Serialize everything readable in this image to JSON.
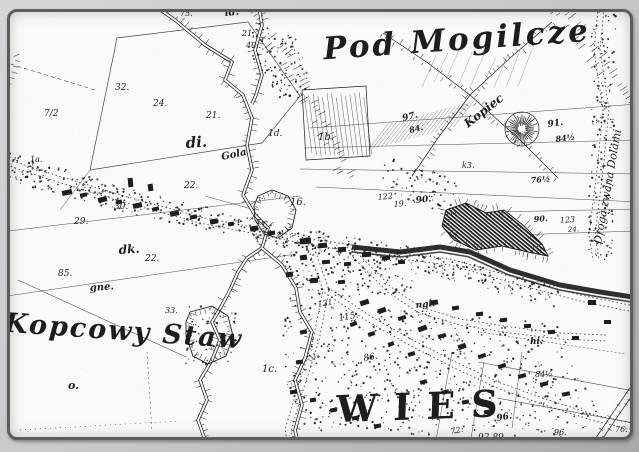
{
  "map": {
    "titles": {
      "region": "Pod Mogilcze",
      "pond": "Kopcowy Staw",
      "village": "WIES",
      "road": "Droga zwana Dolami"
    },
    "colors": {
      "ink": "#1d1d1d",
      "paper": "#fbfaf7",
      "frame": "#5d5d5d",
      "margin": "#c9c9c9"
    },
    "symbols": [
      {
        "name": "mound-hatched-circle",
        "x": 522,
        "y": 129
      },
      {
        "name": "river-double-bank",
        "note": "meandering stream with bank hatching"
      },
      {
        "name": "village-buildings",
        "note": "black rectangles along streets"
      }
    ],
    "labels": [
      {
        "t": "id.",
        "x": 225,
        "y": 16,
        "s": 10,
        "r": -5,
        "c": "s"
      },
      {
        "t": "75.",
        "x": 180,
        "y": 16,
        "s": 8,
        "r": 0,
        "c": "n"
      },
      {
        "t": "21.",
        "x": 242,
        "y": 36,
        "s": 8,
        "r": 0,
        "c": "n"
      },
      {
        "t": "40.",
        "x": 246,
        "y": 48,
        "s": 8,
        "r": 0,
        "c": "n"
      },
      {
        "t": "32.",
        "x": 115,
        "y": 90,
        "s": 9,
        "r": 0,
        "c": "n"
      },
      {
        "t": "7/2",
        "x": 44,
        "y": 116,
        "s": 9,
        "r": 0,
        "c": "n"
      },
      {
        "t": "24.",
        "x": 153,
        "y": 106,
        "s": 9,
        "r": 0,
        "c": "n"
      },
      {
        "t": "21.",
        "x": 206,
        "y": 118,
        "s": 9,
        "r": 0,
        "c": "n"
      },
      {
        "t": "di.",
        "x": 186,
        "y": 148,
        "s": 15,
        "r": -4,
        "c": "s"
      },
      {
        "t": "1d.",
        "x": 268,
        "y": 136,
        "s": 9,
        "r": 0,
        "c": "n"
      },
      {
        "t": "Gola",
        "x": 222,
        "y": 160,
        "s": 10,
        "r": -12,
        "c": "s"
      },
      {
        "t": "1b.",
        "x": 318,
        "y": 140,
        "s": 10,
        "r": 0,
        "c": "n"
      },
      {
        "t": "97.",
        "x": 403,
        "y": 121,
        "s": 9,
        "r": -14,
        "c": "s"
      },
      {
        "t": "84.",
        "x": 410,
        "y": 133,
        "s": 8,
        "r": -14,
        "c": "s"
      },
      {
        "t": "Kopiec",
        "x": 468,
        "y": 128,
        "s": 12,
        "r": -38,
        "c": "s"
      },
      {
        "t": "91.",
        "x": 548,
        "y": 127,
        "s": 9,
        "r": -8,
        "c": "s"
      },
      {
        "t": "84½",
        "x": 556,
        "y": 142,
        "s": 8,
        "r": -8,
        "c": "s"
      },
      {
        "t": "76½",
        "x": 531,
        "y": 183,
        "s": 8,
        "r": -4,
        "c": "s"
      },
      {
        "t": "k3.",
        "x": 462,
        "y": 168,
        "s": 8,
        "r": 0,
        "c": "n"
      },
      {
        "t": "16.",
        "x": 290,
        "y": 205,
        "s": 10,
        "r": 0,
        "c": "n"
      },
      {
        "t": "122",
        "x": 378,
        "y": 200,
        "s": 8,
        "r": -6,
        "c": "n"
      },
      {
        "t": "19.",
        "x": 394,
        "y": 207,
        "s": 8,
        "r": -6,
        "c": "n"
      },
      {
        "t": "90.",
        "x": 416,
        "y": 203,
        "s": 9,
        "r": -6,
        "c": "s"
      },
      {
        "t": "90.",
        "x": 534,
        "y": 222,
        "s": 8,
        "r": -4,
        "c": "s"
      },
      {
        "t": "123",
        "x": 560,
        "y": 223,
        "s": 8,
        "r": -4,
        "c": "n"
      },
      {
        "t": "24.",
        "x": 568,
        "y": 232,
        "s": 7,
        "r": -4,
        "c": "n"
      },
      {
        "t": "30.",
        "x": 114,
        "y": 209,
        "s": 9,
        "r": 0,
        "c": "n"
      },
      {
        "t": "29.",
        "x": 74,
        "y": 224,
        "s": 9,
        "r": 0,
        "c": "n"
      },
      {
        "t": "22.",
        "x": 184,
        "y": 188,
        "s": 9,
        "r": 0,
        "c": "n"
      },
      {
        "t": "dk.",
        "x": 119,
        "y": 254,
        "s": 12,
        "r": -4,
        "c": "s"
      },
      {
        "t": "22.",
        "x": 145,
        "y": 261,
        "s": 9,
        "r": 0,
        "c": "n"
      },
      {
        "t": "85.",
        "x": 58,
        "y": 276,
        "s": 9,
        "r": 0,
        "c": "n"
      },
      {
        "t": "gne.",
        "x": 90,
        "y": 291,
        "s": 10,
        "r": -4,
        "c": "s"
      },
      {
        "t": "33.",
        "x": 165,
        "y": 313,
        "s": 8,
        "r": 0,
        "c": "n"
      },
      {
        "t": "121.",
        "x": 318,
        "y": 307,
        "s": 8,
        "r": -10,
        "c": "n"
      },
      {
        "t": "115.",
        "x": 339,
        "y": 321,
        "s": 9,
        "r": -10,
        "c": "n"
      },
      {
        "t": "86.",
        "x": 364,
        "y": 361,
        "s": 9,
        "r": -10,
        "c": "n"
      },
      {
        "t": "ngl.",
        "x": 416,
        "y": 308,
        "s": 9,
        "r": -6,
        "c": "s"
      },
      {
        "t": "1c.",
        "x": 262,
        "y": 372,
        "s": 10,
        "r": 0,
        "c": "n"
      },
      {
        "t": "o.",
        "x": 68,
        "y": 389,
        "s": 11,
        "r": 0,
        "c": "s"
      },
      {
        "t": "hi.",
        "x": 530,
        "y": 344,
        "s": 9,
        "r": 0,
        "c": "s"
      },
      {
        "t": "84½",
        "x": 535,
        "y": 377,
        "s": 8,
        "r": 0,
        "c": "n"
      },
      {
        "t": "96.",
        "x": 497,
        "y": 421,
        "s": 9,
        "r": -10,
        "c": "s"
      },
      {
        "t": "92 89",
        "x": 478,
        "y": 440,
        "s": 9,
        "r": 0,
        "c": "n"
      },
      {
        "t": "72.",
        "x": 451,
        "y": 434,
        "s": 8,
        "r": -10,
        "c": "n"
      },
      {
        "t": "96.",
        "x": 554,
        "y": 435,
        "s": 8,
        "r": 0,
        "c": "n"
      },
      {
        "t": "76.",
        "x": 615,
        "y": 432,
        "s": 8,
        "r": 0,
        "c": "n"
      },
      {
        "t": "1a.",
        "x": 30,
        "y": 162,
        "s": 8,
        "r": 0,
        "c": "n"
      }
    ]
  }
}
